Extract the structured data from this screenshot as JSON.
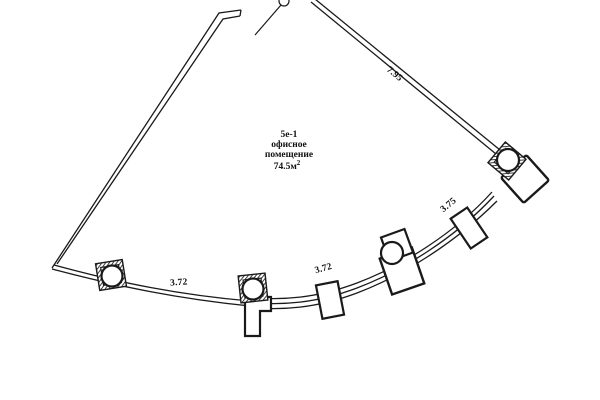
{
  "room": {
    "code": "5е-1",
    "name_line1": "офисное",
    "name_line2": "помещение",
    "area_value": "74.5м",
    "area_superscript": "2"
  },
  "dimensions": {
    "top_right_wall": "7.95",
    "bottom_segment_1": "3.72",
    "bottom_segment_2": "3.72",
    "bottom_segment_3": "3.75"
  },
  "colors": {
    "line": "#1a1a1a",
    "background": "#ffffff"
  }
}
